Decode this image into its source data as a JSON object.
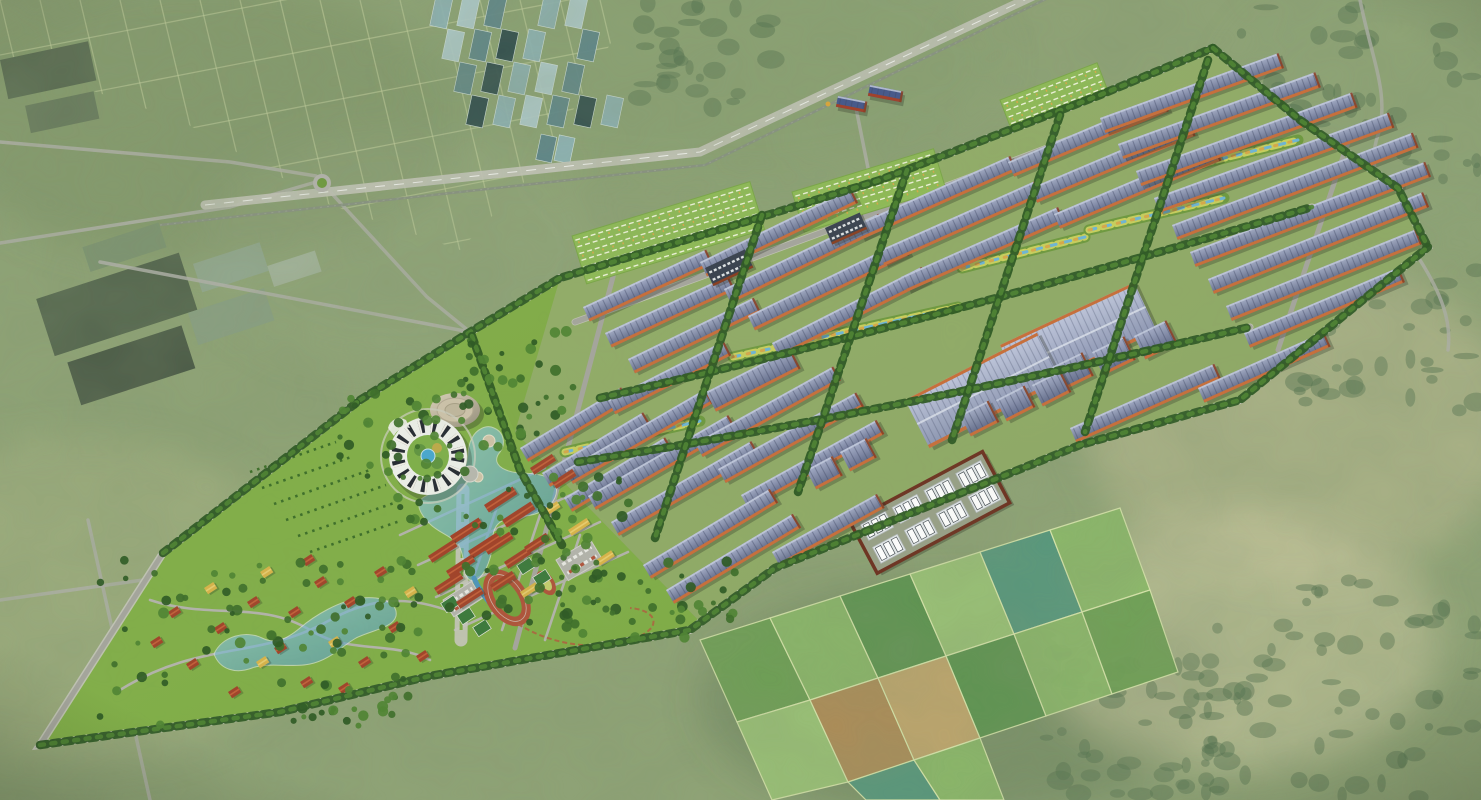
{
  "meta": {
    "description": "Bird's-eye architectural rendering of a large solar-roof industrial park master plan with a landscaped campus (ring building, dome hall, lakes, stadium, villa district) composited onto aerial-photo farmland"
  },
  "colors": {
    "photoBase": "#90a477",
    "photoScrub": "#7d9468",
    "photoPale": "#c9c49c",
    "photoDark": "#55704f",
    "farmLine": "#ccd6a4",
    "forest": "#3c5e38",
    "ghTeal1": "#8fb3b6",
    "ghTeal2": "#b2cdd0",
    "ghTeal3": "#5f868b",
    "ghDark": "#2e4a4c",
    "roadPhoto": "#b2b2aa",
    "highway": "#b7b7b0",
    "rail": "#8a9383",
    "lawn": "#7dab43",
    "lawnDark": "#639334",
    "industrialGround": "#a3ad8a",
    "road": "#a6a69e",
    "roadLight": "#c6c6bd",
    "tree": "#2e5a24",
    "tree2": "#3e6f2a",
    "tree3": "#4f8433",
    "roofLight": "#a6aec9",
    "roofDark": "#5e6787",
    "roofStripe": "#3d4563",
    "eave": "#c96f3b",
    "eaveDark": "#8a3f22",
    "bigRoofLight": "#c0c7dd",
    "bigRoofDark": "#8d96b4",
    "water": "#6fb6d6",
    "waterDeep": "#4f95bb",
    "swaleVeg": "#c9d05e",
    "swaleGold": "#d8a94a",
    "redRoof": "#a2432a",
    "redRoofLight": "#c3603a",
    "yellowRoof": "#d9b44a",
    "yellowRoofLight": "#e8cd6f",
    "track": "#b0533a",
    "infield": "#74a33d",
    "miniInfield": "#c6cf6e",
    "court": "#3c7a3c",
    "white": "#eef0ea",
    "complexWall": "#6e3322",
    "complexGround": "#99a188",
    "unit": "#e6eaec",
    "unitDark": "#4a5158",
    "domeLight": "#ded3bc",
    "domeDark": "#97907d",
    "fieldA": "#6da054",
    "fieldB": "#8cb96a",
    "fieldC": "#5c9450",
    "fieldD": "#9cc478",
    "fieldE": "#56977e",
    "fieldF": "#b08d58",
    "fieldG": "#c3a76e",
    "fieldDivider": "#d9e6ac"
  },
  "geometry": {
    "sitePoints": "40,745 163,553 360,400 470,332 560,278 745,222 880,180 1100,95 1213,48 1300,120 1398,188 1428,247 1240,400 1080,445 775,568 690,630 430,676 280,712",
    "industrialTint": "515,432 560,278 745,222 880,180 1100,95 1213,48 1300,120 1398,188 1428,247 1240,400 1080,445 775,568 700,622",
    "campusTint": "40,745 163,553 360,400 470,332 515,432 700,622 690,630 430,676 280,712",
    "boundary": "M40,745 L163,553 L360,400 L470,332 L560,278 L745,222 L880,180 L1100,95 L1213,48 L1300,120 L1398,188 L1428,247 L1240,400 L1080,445 L775,568 L690,630 L430,676 L280,712 Z",
    "farmClip": "0,0 635,0 545,160 460,250 330,205 180,120 0,60",
    "highway": "M205,205 L700,152 L1110,-40",
    "rail": "M160,225 L705,165 L1085,-20",
    "warehouses": [
      [
        520,
        448,
        118,
        -31
      ],
      [
        542,
        473,
        118,
        -31
      ],
      [
        564,
        498,
        118,
        -31
      ],
      [
        583,
        307,
        136,
        -25
      ],
      [
        605,
        333,
        136,
        -25
      ],
      [
        628,
        359,
        140,
        -26
      ],
      [
        700,
        262,
        168,
        -26
      ],
      [
        724,
        289,
        172,
        -26
      ],
      [
        748,
        316,
        172,
        -26
      ],
      [
        772,
        343,
        168,
        -27
      ],
      [
        855,
        225,
        170,
        -24
      ],
      [
        878,
        251,
        172,
        -24
      ],
      [
        901,
        277,
        172,
        -24
      ],
      [
        1008,
        162,
        168,
        -23
      ],
      [
        1031,
        188,
        172,
        -23
      ],
      [
        1054,
        214,
        175,
        -23
      ],
      [
        1100,
        118,
        190,
        -20
      ],
      [
        1118,
        144,
        210,
        -20
      ],
      [
        1136,
        171,
        230,
        -20
      ],
      [
        1154,
        198,
        250,
        -20
      ],
      [
        1172,
        225,
        258,
        -21
      ],
      [
        1190,
        252,
        252,
        -21
      ],
      [
        1208,
        279,
        232,
        -22
      ],
      [
        1226,
        306,
        205,
        -22
      ],
      [
        1244,
        333,
        168,
        -23
      ],
      [
        1070,
        428,
        158,
        -24
      ],
      [
        1198,
        388,
        138,
        -24
      ],
      [
        565,
        470,
        162,
        -30
      ],
      [
        588,
        496,
        162,
        -30
      ],
      [
        611,
        522,
        162,
        -30
      ],
      [
        695,
        443,
        158,
        -29
      ],
      [
        718,
        469,
        158,
        -29
      ],
      [
        741,
        495,
        155,
        -29
      ],
      [
        643,
        565,
        148,
        -31
      ],
      [
        666,
        590,
        148,
        -31
      ],
      [
        772,
        552,
        120,
        -29
      ],
      [
        608,
        400,
        130,
        -27
      ]
    ],
    "bigs": [
      [
        1000,
        345,
        148,
        54,
        -25
      ],
      [
        905,
        400,
        148,
        54,
        -27
      ]
    ],
    "squares": [
      [
        1050,
        368,
        36,
        26,
        -26
      ],
      [
        1092,
        352,
        36,
        26,
        -26
      ],
      [
        1134,
        336,
        36,
        26,
        -26
      ],
      [
        960,
        415,
        32,
        24,
        -27
      ],
      [
        996,
        400,
        32,
        24,
        -27
      ],
      [
        1032,
        385,
        32,
        24,
        -27
      ],
      [
        806,
        470,
        30,
        22,
        -28
      ],
      [
        840,
        452,
        30,
        22,
        -28
      ],
      [
        706,
        392,
        95,
        22,
        -27
      ]
    ],
    "plants": [
      [
        705,
        268,
        44,
        20,
        -25
      ],
      [
        825,
        228,
        38,
        18,
        -24
      ]
    ],
    "depot": [
      [
        838,
        96,
        30,
        11,
        -18
      ],
      [
        870,
        85,
        34,
        11,
        -18
      ]
    ],
    "complex": [
      850,
      522,
      150,
      58,
      -28
    ],
    "gardens": [
      [
        572,
        236,
        186,
        50,
        -17
      ],
      [
        792,
        192,
        148,
        42,
        -17
      ],
      [
        1000,
        100,
        104,
        34,
        -21
      ]
    ],
    "parkings": [
      [
        556,
        560,
        40,
        24,
        -31
      ],
      [
        443,
        600,
        34,
        20,
        -33
      ]
    ],
    "courts": [
      [
        526,
        566
      ],
      [
        542,
        578
      ],
      [
        450,
        604
      ],
      [
        466,
        616
      ],
      [
        482,
        628
      ]
    ],
    "villas": [
      [
        150,
        642,
        0
      ],
      [
        168,
        612,
        0
      ],
      [
        186,
        664,
        0
      ],
      [
        204,
        588,
        1
      ],
      [
        214,
        628,
        0
      ],
      [
        228,
        692,
        0
      ],
      [
        247,
        602,
        0
      ],
      [
        260,
        572,
        1
      ],
      [
        274,
        648,
        0
      ],
      [
        288,
        612,
        0
      ],
      [
        300,
        682,
        0
      ],
      [
        314,
        582,
        0
      ],
      [
        328,
        642,
        1
      ],
      [
        344,
        602,
        0
      ],
      [
        358,
        662,
        0
      ],
      [
        374,
        572,
        0
      ],
      [
        388,
        627,
        0
      ],
      [
        404,
        592,
        1
      ],
      [
        416,
        656,
        0
      ],
      [
        302,
        560,
        0
      ],
      [
        256,
        662,
        1
      ],
      [
        338,
        688,
        0
      ]
    ],
    "campus": [
      [
        484,
        505,
        34,
        9,
        0
      ],
      [
        502,
        520,
        34,
        9,
        0
      ],
      [
        450,
        536,
        34,
        9,
        0
      ],
      [
        468,
        551,
        34,
        9,
        0
      ],
      [
        428,
        556,
        30,
        8,
        0
      ],
      [
        446,
        571,
        30,
        8,
        0
      ],
      [
        484,
        548,
        30,
        8,
        0
      ],
      [
        504,
        562,
        28,
        8,
        0
      ],
      [
        524,
        547,
        26,
        8,
        0
      ],
      [
        434,
        588,
        30,
        8,
        0
      ],
      [
        456,
        602,
        28,
        8,
        0
      ],
      [
        490,
        585,
        26,
        8,
        0
      ],
      [
        568,
        530,
        22,
        7,
        1
      ],
      [
        540,
        512,
        20,
        7,
        1
      ],
      [
        596,
        560,
        18,
        7,
        1
      ],
      [
        520,
        592,
        18,
        7,
        1
      ],
      [
        530,
        468,
        26,
        8,
        0
      ],
      [
        552,
        482,
        24,
        8,
        0
      ]
    ],
    "swales": [
      "M733,357 L958,307",
      "M962,268 L1085,237",
      "M1089,230 L1224,198",
      "M565,452 L700,421",
      "M1176,170 L1298,140"
    ],
    "longRoads": [
      "M575,322 Q900,206 1224,80",
      "M600,398 C800,352 1030,292 1312,207",
      "M578,462 C770,432 1000,386 1250,327"
    ],
    "crossRoads": [
      "M618,258 L515,648",
      "M762,215 L655,538",
      "M907,170 L798,492",
      "M1060,115 L952,440",
      "M1208,60 L1085,432",
      "M1348,142 L1278,350"
    ],
    "campusRoads": [
      "M400,535 L545,468",
      "M418,565 L575,493",
      "M436,597 L600,522",
      "M455,630 L628,552",
      "M500,498 L462,612",
      "M540,515 L502,630",
      "M580,535 L545,640",
      "M120,690 C200,640 260,660 330,620 C380,592 420,600 452,612",
      "M150,600 C210,620 260,600 310,630 C350,655 390,640 430,660"
    ],
    "photoRoads": [
      "M0,142 L230,162 L316,176",
      "M0,243 L230,207 L316,182",
      "M100,262 L470,332",
      "M322,183 L427,297 L470,332",
      "M88,520 L150,800",
      "M0,600 L200,572 L352,545",
      "M856,108 L872,188",
      "M1360,0 C1372,60 1390,95 1378,135 C1362,180 1398,225 1420,260 C1440,292 1452,320 1448,350"
    ],
    "treeLines": [
      "M360,400 L470,332 L560,278 L745,222 L880,180 L1100,95 L1213,48",
      "M1213,48 L1300,120 L1398,188 L1428,247",
      "M40,745 L280,712 L430,676 L690,630 L775,568 L1080,445 L1240,400 L1428,247",
      "M163,553 L360,400",
      "M472,336 L520,470 L562,545",
      "M600,398 C800,352 1030,292 1312,207",
      "M578,462 C770,432 1000,386 1250,327",
      "M762,215 L655,538",
      "M907,170 L798,492",
      "M1060,115 L952,440",
      "M1208,60 L1085,432"
    ],
    "treeZones": [
      [
        100,
        560,
        320,
        170,
        90
      ],
      [
        390,
        470,
        240,
        160,
        70
      ],
      [
        455,
        330,
        120,
        120,
        40
      ],
      [
        560,
        560,
        180,
        80,
        36
      ],
      [
        340,
        390,
        130,
        90,
        30
      ]
    ],
    "scrubZones": [
      [
        1160,
        580,
        320,
        220,
        60
      ],
      [
        1290,
        250,
        190,
        180,
        40
      ],
      [
        1030,
        640,
        220,
        160,
        55
      ],
      [
        1240,
        0,
        240,
        200,
        40
      ],
      [
        620,
        0,
        160,
        110,
        30
      ]
    ],
    "fields": [
      [
        700,
        640,
        770,
        618,
        810,
        700,
        737,
        722,
        "fieldA"
      ],
      [
        770,
        618,
        840,
        596,
        878,
        678,
        810,
        700,
        "fieldB"
      ],
      [
        840,
        596,
        910,
        574,
        946,
        656,
        878,
        678,
        "fieldC"
      ],
      [
        910,
        574,
        980,
        552,
        1014,
        634,
        946,
        656,
        "fieldD"
      ],
      [
        980,
        552,
        1050,
        530,
        1082,
        612,
        1014,
        634,
        "fieldE"
      ],
      [
        1050,
        530,
        1120,
        508,
        1150,
        590,
        1082,
        612,
        "fieldB"
      ],
      [
        737,
        722,
        810,
        700,
        848,
        782,
        772,
        800,
        "fieldD"
      ],
      [
        810,
        700,
        878,
        678,
        914,
        760,
        848,
        782,
        "fieldF"
      ],
      [
        878,
        678,
        946,
        656,
        980,
        738,
        914,
        760,
        "fieldG"
      ],
      [
        946,
        656,
        1014,
        634,
        1046,
        716,
        980,
        738,
        "fieldC"
      ],
      [
        1014,
        634,
        1082,
        612,
        1112,
        694,
        1046,
        716,
        "fieldB"
      ],
      [
        1082,
        612,
        1150,
        590,
        1178,
        672,
        1112,
        694,
        "fieldA"
      ],
      [
        848,
        782,
        914,
        760,
        940,
        800,
        866,
        800,
        "fieldE"
      ],
      [
        914,
        760,
        980,
        738,
        1004,
        800,
        940,
        800,
        "fieldB"
      ]
    ]
  }
}
